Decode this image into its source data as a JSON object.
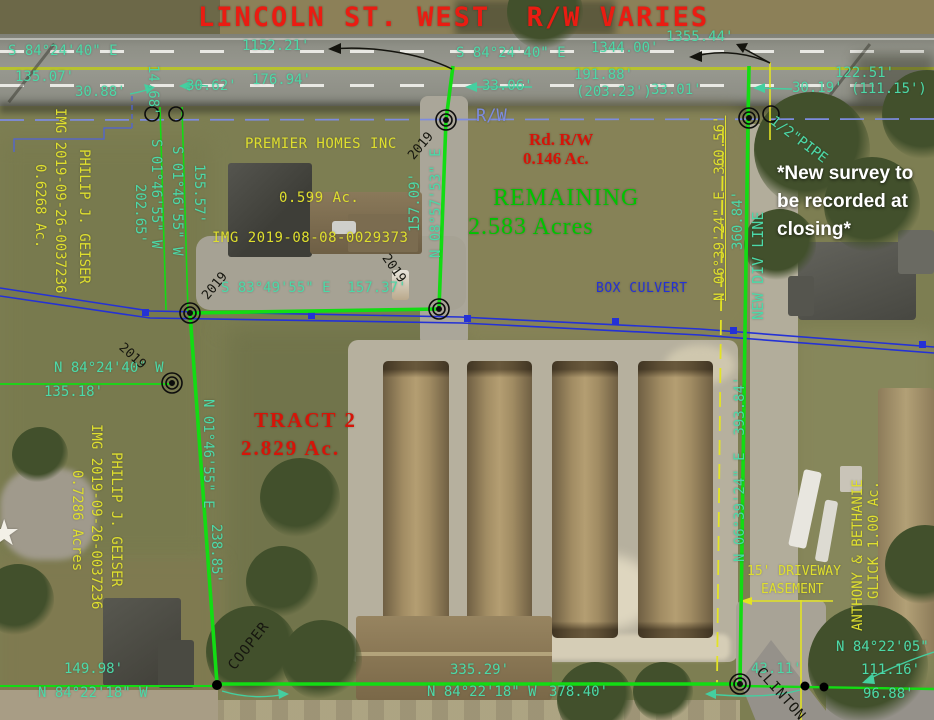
{
  "colors": {
    "boundary_green": "#13dc13",
    "survey_teal": "#4cd9a8",
    "parcel_yellow": "#dfdf2e",
    "culvert_blue": "#2431d6",
    "rw_periwinkle": "#7d8ce0",
    "title_red": "#ea1c12",
    "remaining_green": "#00c400",
    "note_white": "#ffffff",
    "ink_black": "#16160f"
  },
  "labels": [
    {
      "id": "street-title",
      "cls": "r1",
      "text": "LINCOLN ST. WEST  R/W VARIES",
      "x": 198,
      "y": 3,
      "fs": 27,
      "ls": 2
    },
    {
      "id": "bearing-top-left",
      "cls": "t",
      "text": "S 84°24'40\" E",
      "x": 8,
      "y": 44
    },
    {
      "id": "dim-1152-21",
      "cls": "t",
      "text": "1152.21'",
      "x": 242,
      "y": 39
    },
    {
      "id": "bearing-top-mid",
      "cls": "t",
      "text": "S 84°24'40\" E",
      "x": 456,
      "y": 46
    },
    {
      "id": "dim-1344-00",
      "cls": "t",
      "text": "1344.00'",
      "x": 591,
      "y": 41
    },
    {
      "id": "dim-1355-44",
      "cls": "t",
      "text": "1355.44'",
      "x": 666,
      "y": 30
    },
    {
      "id": "dim-135-07",
      "cls": "t",
      "text": "135.07'",
      "x": 15,
      "y": 70
    },
    {
      "id": "dim-30-88",
      "cls": "t",
      "text": "30.88'",
      "x": 75,
      "y": 85
    },
    {
      "id": "dim-14-68",
      "cls": "t",
      "text": "14.68'",
      "x": 160,
      "y": 65,
      "rot": 90
    },
    {
      "id": "dim-30-62",
      "cls": "t",
      "text": "30.62'",
      "x": 186,
      "y": 79
    },
    {
      "id": "dim-176-94",
      "cls": "t",
      "text": "176.94'",
      "x": 252,
      "y": 73
    },
    {
      "id": "dim-33-06",
      "cls": "t",
      "text": "33.06'",
      "x": 482,
      "y": 79
    },
    {
      "id": "dim-191-88",
      "cls": "t",
      "text": "191.88'",
      "x": 574,
      "y": 68
    },
    {
      "id": "dim-203-23",
      "cls": "t",
      "text": "(203.23')",
      "x": 576,
      "y": 85
    },
    {
      "id": "dim-33-01",
      "cls": "t",
      "text": "33.01'",
      "x": 651,
      "y": 83
    },
    {
      "id": "dim-30-19",
      "cls": "t",
      "text": "30.19'",
      "x": 792,
      "y": 81
    },
    {
      "id": "dim-122-51",
      "cls": "t",
      "text": "122.51'",
      "x": 835,
      "y": 66
    },
    {
      "id": "dim-111-15",
      "cls": "t",
      "text": "(111.15')",
      "x": 851,
      "y": 82
    },
    {
      "id": "rw-label",
      "cls": "pw",
      "text": "R/W",
      "x": 476,
      "y": 107,
      "fs": 17
    },
    {
      "id": "rd-rw-title",
      "cls": "r2",
      "text": "Rd. R/W",
      "x": 529,
      "y": 130,
      "fs": 17
    },
    {
      "id": "rd-rw-area",
      "cls": "r2",
      "text": "0.146 Ac.",
      "x": 523,
      "y": 149,
      "fs": 17
    },
    {
      "id": "remaining-title",
      "cls": "g",
      "text": "REMAINING",
      "x": 493,
      "y": 185,
      "fs": 24
    },
    {
      "id": "remaining-area",
      "cls": "g",
      "text": "2.583 Acres",
      "x": 468,
      "y": 214,
      "fs": 24
    },
    {
      "id": "note-line-1",
      "cls": "w",
      "text": "*New survey to",
      "x": 777,
      "y": 163
    },
    {
      "id": "note-line-2",
      "cls": "w",
      "text": "be recorded at",
      "x": 777,
      "y": 191
    },
    {
      "id": "note-line-3",
      "cls": "w",
      "text": "closing*",
      "x": 777,
      "y": 219
    },
    {
      "id": "pipe-label",
      "cls": "t",
      "text": "1/2\"PIPE",
      "x": 776,
      "y": 114,
      "rot": 37
    },
    {
      "id": "premier-name",
      "cls": "y",
      "text": "PREMIER HOMES INC",
      "x": 245,
      "y": 137,
      "ls": 0.5
    },
    {
      "id": "premier-area",
      "cls": "y",
      "text": "0.599 Ac.",
      "x": 279,
      "y": 191,
      "ls": 0.5
    },
    {
      "id": "premier-img",
      "cls": "y",
      "text": "IMG 2019-08-08-0029373",
      "x": 212,
      "y": 231,
      "ls": 0.5
    },
    {
      "id": "bearing-s0146-outer",
      "cls": "t",
      "text": "S 01°46'55\" W",
      "x": 163,
      "y": 139,
      "rot": 90
    },
    {
      "id": "dim-202-65",
      "cls": "t",
      "text": "202.65'",
      "x": 147,
      "y": 184,
      "rot": 90
    },
    {
      "id": "bearing-s0146-inner",
      "cls": "t",
      "text": "S 01°46'55\" W",
      "x": 184,
      "y": 146,
      "rot": 90
    },
    {
      "id": "dim-155-57",
      "cls": "t",
      "text": "155.57'",
      "x": 206,
      "y": 164,
      "rot": 90
    },
    {
      "id": "dim-157-09",
      "cls": "t",
      "text": "157.09'",
      "x": 408,
      "y": 232,
      "rot": -90
    },
    {
      "id": "bearing-n0857",
      "cls": "t",
      "text": "N 08°57'53\" E",
      "x": 429,
      "y": 258,
      "rot": -90
    },
    {
      "id": "geiser1-name",
      "cls": "y",
      "text": "PHILIP J. GEISER",
      "x": 91,
      "y": 149,
      "rot": 90
    },
    {
      "id": "geiser1-img",
      "cls": "y",
      "text": "IMG 2019-09-26-0037236",
      "x": 67,
      "y": 108,
      "rot": 90
    },
    {
      "id": "geiser1-area",
      "cls": "y",
      "text": "0.6268 Ac.",
      "x": 47,
      "y": 164,
      "rot": 90
    },
    {
      "id": "bearing-s8349",
      "cls": "t",
      "text": "S 83°49'55\" E  157.37'",
      "x": 221,
      "y": 281
    },
    {
      "id": "box-culvert-label",
      "cls": "bl",
      "text": "BOX CULVERT",
      "x": 596,
      "y": 282,
      "fs": 13,
      "ls": 0.5
    },
    {
      "id": "bearing-n8424w",
      "cls": "t",
      "text": "N 84°24'40\" W",
      "x": 54,
      "y": 361
    },
    {
      "id": "dim-135-18",
      "cls": "t",
      "text": "135.18'",
      "x": 44,
      "y": 385
    },
    {
      "id": "year-2019-a",
      "cls": "k",
      "text": "2019",
      "x": 406,
      "y": 154,
      "rot": -50,
      "fs": 13
    },
    {
      "id": "year-2019-b",
      "cls": "k",
      "text": "2019",
      "x": 200,
      "y": 294,
      "rot": -50,
      "fs": 13
    },
    {
      "id": "year-2019-c",
      "cls": "k",
      "text": "2019",
      "x": 125,
      "y": 341,
      "rot": 42,
      "fs": 13
    },
    {
      "id": "year-2019-d",
      "cls": "k",
      "text": "2019",
      "x": 390,
      "y": 252,
      "rot": 55,
      "fs": 13
    },
    {
      "id": "tract2-title",
      "cls": "r2",
      "text": "TRACT 2",
      "x": 254,
      "y": 409,
      "fs": 21,
      "ls": 2
    },
    {
      "id": "tract2-area",
      "cls": "r2",
      "text": "2.829 Ac.",
      "x": 241,
      "y": 437,
      "fs": 21,
      "ls": 2
    },
    {
      "id": "bearing-n0146e",
      "cls": "t",
      "text": "N 01°46'55\" E",
      "x": 215,
      "y": 399,
      "rot": 90
    },
    {
      "id": "dim-238-85",
      "cls": "t",
      "text": "238.85'",
      "x": 223,
      "y": 524,
      "rot": 90
    },
    {
      "id": "bearing-n0639-360",
      "cls": "y",
      "text": "N 06°39'24\" E  360.56'",
      "x": 713,
      "y": 301,
      "rot": -90,
      "und": 1
    },
    {
      "id": "dim-360-84",
      "cls": "t",
      "text": "360.84'",
      "x": 731,
      "y": 250,
      "rot": -90
    },
    {
      "id": "new-div-line-label",
      "cls": "t",
      "text": "NEW DIV LINE",
      "x": 750,
      "y": 320,
      "rot": -90,
      "fs": 15
    },
    {
      "id": "bearing-n0639-393",
      "cls": "t",
      "text": "N 06°39'24\" E  393.84'",
      "x": 733,
      "y": 562,
      "rot": -90
    },
    {
      "id": "easement-line-1",
      "cls": "y",
      "text": "15' DRIVEWAY",
      "x": 747,
      "y": 565,
      "fs": 13
    },
    {
      "id": "easement-line-2",
      "cls": "y",
      "text": "EASEMENT",
      "x": 761,
      "y": 583,
      "fs": 13
    },
    {
      "id": "glick-name-1",
      "cls": "y",
      "text": "ANTHONY & BETHANIE",
      "x": 851,
      "y": 631,
      "rot": -90
    },
    {
      "id": "glick-name-2",
      "cls": "y",
      "text": "GLICK 1.00 Ac.",
      "x": 867,
      "y": 599,
      "rot": -90
    },
    {
      "id": "geiser2-name",
      "cls": "y",
      "text": "PHILIP J. GEISER",
      "x": 123,
      "y": 452,
      "rot": 90
    },
    {
      "id": "geiser2-img",
      "cls": "y",
      "text": "IMG 2019-09-26-0037236",
      "x": 103,
      "y": 424,
      "rot": 90
    },
    {
      "id": "geiser2-area",
      "cls": "y",
      "text": "0.7286 Acres",
      "x": 84,
      "y": 470,
      "rot": 90
    },
    {
      "id": "dim-149-98",
      "cls": "t",
      "text": "149.98'",
      "x": 64,
      "y": 662
    },
    {
      "id": "bearing-n8422w-left",
      "cls": "t",
      "text": "N 84°22'18\" W",
      "x": 38,
      "y": 686
    },
    {
      "id": "cooper-label",
      "cls": "k",
      "text": "COOPER",
      "x": 226,
      "y": 664,
      "rot": -52,
      "ls": 1
    },
    {
      "id": "dim-335-29",
      "cls": "t",
      "text": "335.29'",
      "x": 450,
      "y": 663
    },
    {
      "id": "bearing-n8422w-mid",
      "cls": "t",
      "text": "N 84°22'18\" W",
      "x": 427,
      "y": 685
    },
    {
      "id": "dim-378-40",
      "cls": "t",
      "text": "378.40'",
      "x": 549,
      "y": 685
    },
    {
      "id": "dim-43-11",
      "cls": "t",
      "text": "43.11'",
      "x": 751,
      "y": 662
    },
    {
      "id": "bearing-n8422e",
      "cls": "t",
      "text": "N 84°22'05\"",
      "x": 836,
      "y": 640
    },
    {
      "id": "dim-111-16",
      "cls": "t",
      "text": "111.16'",
      "x": 861,
      "y": 663
    },
    {
      "id": "dim-96-88",
      "cls": "t",
      "text": "96.88'",
      "x": 863,
      "y": 687
    },
    {
      "id": "clinton-label",
      "cls": "k",
      "text": "CLINTON",
      "x": 764,
      "y": 665,
      "rot": 48,
      "ls": 1
    },
    {
      "id": "star-symbol",
      "cls": "star",
      "text": "★",
      "x": -12,
      "y": 514,
      "fs": 36
    }
  ]
}
